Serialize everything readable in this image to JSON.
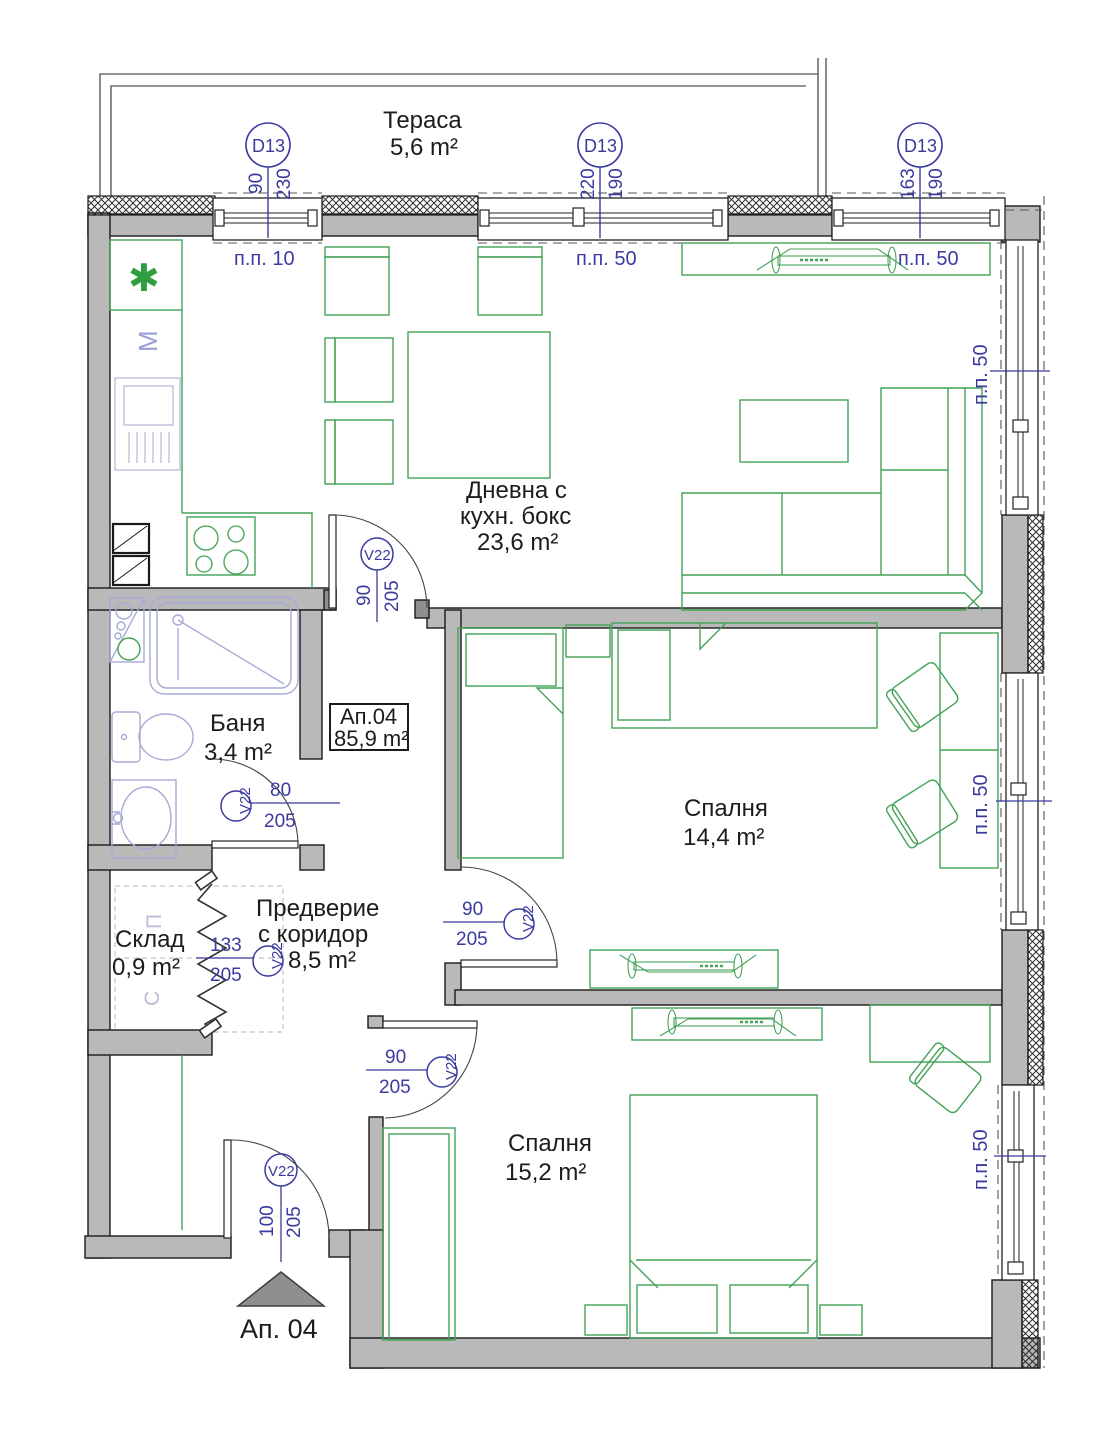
{
  "colors": {
    "wall_fill": "#b9b9b9",
    "wall_stroke": "#1a1a1a",
    "furniture_green": "#44a257",
    "plumbing_blue": "#a6abd6",
    "marker_blue": "#3b3b9f",
    "text_black": "#1c1c1c",
    "entry_arrow_gray": "#8f8f8f"
  },
  "terrace": {
    "name": "Тераса",
    "area": "5,6 m²"
  },
  "rooms": {
    "living": {
      "line1": "Дневна с",
      "line2": "кухн. бокс",
      "area": "23,6 m²"
    },
    "bath": {
      "name": "Баня",
      "area": "3,4 m²"
    },
    "bedroom1": {
      "name": "Спалня",
      "area": "14,4 m²"
    },
    "hall": {
      "line1": "Предверие",
      "line2": "с коридор",
      "area": "8,5 m²"
    },
    "storage": {
      "name": "Склад",
      "area": "0,9 m²"
    },
    "bedroom2": {
      "name": "Спалня",
      "area": "15,2 m²"
    }
  },
  "apartment_box": {
    "id": "Ап.04",
    "area": "85,9 m²"
  },
  "entrance_label": "Ап. 04",
  "window_markers": [
    {
      "id": "D13",
      "w": "90",
      "h": "230",
      "sill": "п.п. 10"
    },
    {
      "id": "D13",
      "w": "220",
      "h": "190",
      "sill": "п.п. 50"
    },
    {
      "id": "D13",
      "w": "163",
      "h": "190",
      "sill": "п.п. 50"
    }
  ],
  "side_sills": [
    {
      "label": "п.п. 50"
    },
    {
      "label": "п.п. 50"
    },
    {
      "label": "п.п. 50"
    }
  ],
  "door_markers": [
    {
      "id": "V22",
      "w": "90",
      "h": "205"
    },
    {
      "id": "V22",
      "w": "80",
      "h": "205"
    },
    {
      "id": "V22",
      "w": "133",
      "h": "205"
    },
    {
      "id": "V22",
      "w": "90",
      "h": "205"
    },
    {
      "id": "V22",
      "w": "90",
      "h": "205"
    },
    {
      "id": "V22",
      "w": "100",
      "h": "205"
    }
  ],
  "storage_letters": {
    "top": "П",
    "bottom": "С"
  },
  "kitchen_symbols": {
    "washer_letter": "М",
    "asterisk": "✱"
  }
}
